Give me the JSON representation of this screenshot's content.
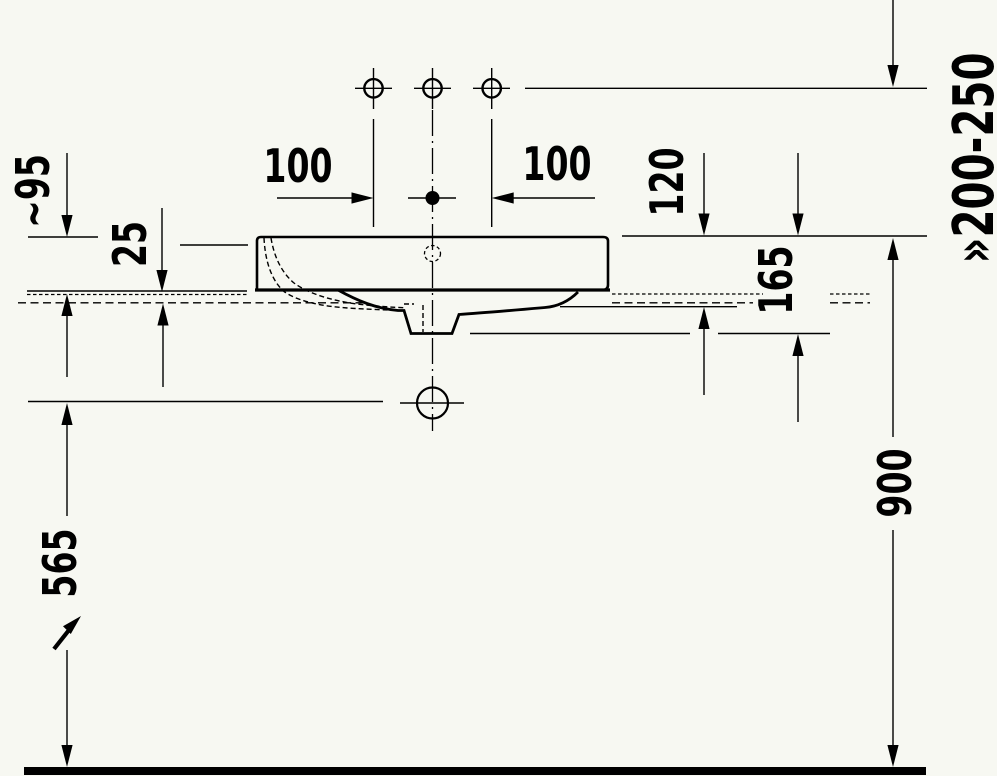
{
  "drawing": {
    "title": "washbasin-installation-side-view",
    "colors": {
      "background": "#f7f8f2",
      "line": "#000000"
    },
    "labels": {
      "dim_100_left": "100",
      "dim_100_right": "100",
      "dim_120": "120",
      "dim_165": "165",
      "dim_tilde95": "~95",
      "dim_25": "25",
      "dim_565": "565",
      "dim_900": "900",
      "dim_200_250": "»200-250"
    }
  }
}
